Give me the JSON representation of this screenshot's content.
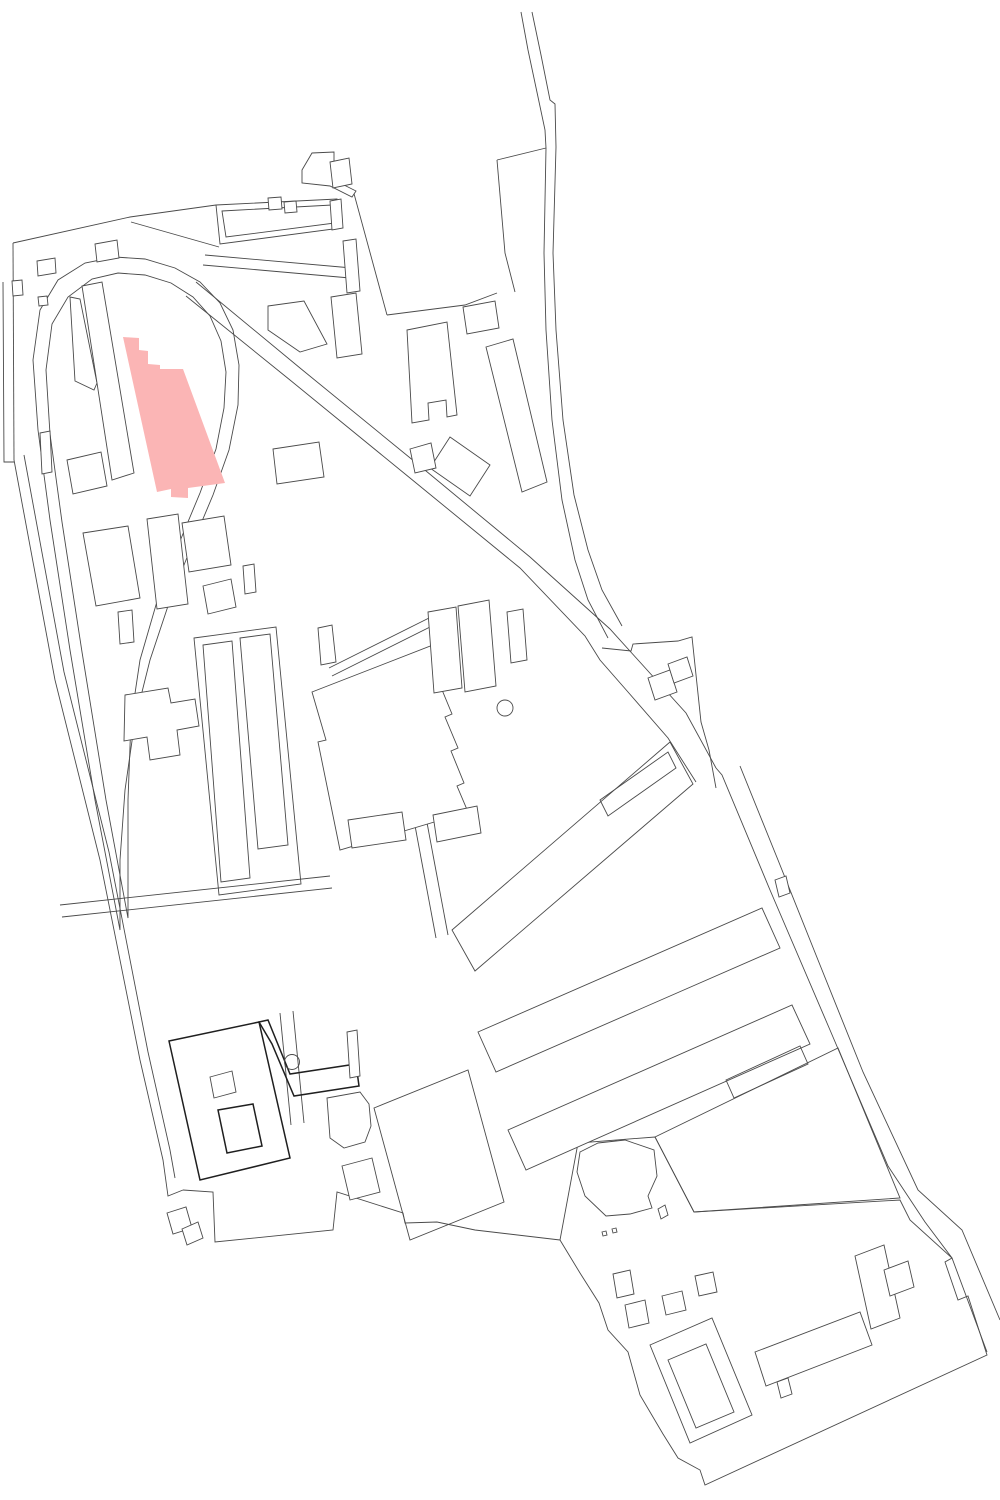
{
  "map": {
    "canvas": {
      "width": 1000,
      "height": 1500,
      "background": "#ffffff"
    },
    "style": {
      "line_color": "#4a4a4a",
      "line_width": 0.9,
      "emphasis_color": "#1f1f1f",
      "emphasis_width": 1.5,
      "building_fill": "#ffffff",
      "highlight_fill": "#fbb5b5"
    },
    "highlight": {
      "name": "highlighted-building",
      "fill": "highlight",
      "points": "123,337 139,338 139,350 148,351 148,364 160,365 160,369 183,369 225,483 188,488 188,498 171,497 171,489 157,492"
    },
    "features": [
      {
        "name": "boundary-top-left",
        "type": "line",
        "points": "13,243 130,217 216,205"
      },
      {
        "name": "boundary-left-vertical",
        "type": "line",
        "points": "13,243 14,460"
      },
      {
        "name": "boundary-left-outer",
        "type": "line",
        "points": "3,282 4,462 14,462"
      },
      {
        "name": "boundary-left-slant-outer",
        "type": "line",
        "points": "14,460 55,680 100,860 140,1060 163,1160 168,1196 183,1190"
      },
      {
        "name": "boundary-left-slant-inner",
        "type": "line",
        "points": "24,455 64,672 109,852 148,1052 170,1150 175,1178"
      },
      {
        "name": "boundary-bottom",
        "type": "line",
        "points": "183,1190 213,1192 215,1242 333,1230 337,1192 403,1213 405,1223 437,1222 475,1230 560,1240"
      },
      {
        "name": "loop-road-outer",
        "type": "polygon",
        "points": "120,930 95,800 70,650 50,520 38,430 33,360 40,310 58,280 85,263 115,257 145,259 175,268 200,282 220,303 233,330 239,365 238,405 229,450 213,495 192,545 170,600 150,660 135,720 125,790 120,860"
      },
      {
        "name": "loop-road-inner",
        "type": "polygon",
        "points": "128,918 106,800 82,652 62,522 50,434 46,370 52,324 68,297 92,279 118,273 145,275 171,283 193,297 210,316 221,341 226,372 224,408 216,449 200,493 180,541 158,598 140,660 131,720 128,800"
      },
      {
        "name": "road-diagonal-upper",
        "type": "line",
        "points": "196,282 300,368 420,466 530,557 610,629 686,713 716,768"
      },
      {
        "name": "road-diagonal-lower",
        "type": "line",
        "points": "186,296 290,380 410,478 520,568 585,636 600,660 628,692 668,738 696,782"
      },
      {
        "name": "road-east-band-left",
        "type": "line",
        "points": "716,768 722,775 770,890 830,1030 888,1166 925,1222 952,1258 987,1352"
      },
      {
        "name": "road-east-band-right",
        "type": "line",
        "points": "740,766 778,860 818,960 863,1072 918,1190 962,1230 1000,1320"
      },
      {
        "name": "road-s-curve-left",
        "type": "line",
        "points": "521,12 528,50 538,97 545,130 546,148 544,253 546,330 552,420 562,500 575,560 588,600 608,638"
      },
      {
        "name": "road-s-curve-right",
        "type": "line",
        "points": "532,12 541,55 550,100 555,104 556,147 553,253 556,330 563,420 574,495 588,550 602,590 622,626"
      },
      {
        "name": "field-north-boundary",
        "type": "line",
        "points": "387,315 465,305 497,293"
      },
      {
        "name": "field-west-boundary",
        "type": "line",
        "points": "353,190 387,315"
      },
      {
        "name": "wedge-left-boundary",
        "type": "line",
        "points": "497,160 505,253 515,292"
      },
      {
        "name": "wedge-top-boundary",
        "type": "line",
        "points": "497,160 546,148"
      },
      {
        "name": "field-east-boundary",
        "type": "line",
        "points": "602,648 631,651 633,644 678,641 692,637 701,722 709,750 716,788"
      },
      {
        "name": "top-band-inner-line",
        "type": "line",
        "points": "131,222 219,247"
      },
      {
        "name": "road-top-cluster-a",
        "type": "line",
        "points": "205,255 352,268"
      },
      {
        "name": "road-top-cluster-b",
        "type": "line",
        "points": "203,265 350,278"
      },
      {
        "name": "road-mid-horizontal-a",
        "type": "line",
        "points": "60,905 330,876"
      },
      {
        "name": "road-mid-horizontal-b",
        "type": "line",
        "points": "62,917 332,888"
      },
      {
        "name": "street-center-a",
        "type": "line",
        "points": "413,815 436,938"
      },
      {
        "name": "street-center-b",
        "type": "line",
        "points": "425,812 448,935"
      },
      {
        "name": "street-left-cluster-a",
        "type": "line",
        "points": "280,1013 291,1125"
      },
      {
        "name": "street-left-cluster-b",
        "type": "line",
        "points": "293,1011 304,1123"
      },
      {
        "name": "path-band-a",
        "type": "line",
        "points": "329,668 441,612"
      },
      {
        "name": "path-band-b",
        "type": "line",
        "points": "332,676 444,620"
      },
      {
        "name": "block-bottomright-outline",
        "type": "polygon",
        "points": "655,1137 838,1048 900,1198 694,1212"
      },
      {
        "name": "compound-outline",
        "type": "polygon",
        "points": "560,1240 578,1143 655,1137 694,1212 900,1200 910,1220 952,1258 945,1262 958,1300 968,1296 987,1355 705,1485 700,1470 678,1458 663,1434 640,1395 628,1352 608,1330 599,1303 580,1273"
      },
      {
        "name": "band-bump-upper",
        "type": "polygon",
        "points": "775,880 786,876 790,893 779,897",
        "fill": "white"
      },
      {
        "name": "band-bump-lower",
        "type": "polygon",
        "points": "777,1382 788,1378 792,1394 781,1398",
        "fill": "white"
      },
      {
        "name": "building-hall-outer",
        "type": "polygon",
        "points": "216,205 337,199 341,228 220,244",
        "fill": "white"
      },
      {
        "name": "building-hall-inner",
        "type": "polygon",
        "points": "222,211 332,205 335,223 226,237"
      },
      {
        "name": "building-hall-annex-a",
        "type": "polygon",
        "points": "268,198 281,197 282,209 269,210",
        "fill": "white"
      },
      {
        "name": "building-hall-annex-b",
        "type": "polygon",
        "points": "284,202 296,201 297,212 285,213",
        "fill": "white"
      },
      {
        "name": "building-tower",
        "type": "polygon",
        "points": "302,170 312,153 334,152 334,180 356,191 352,197 330,186 302,183",
        "fill": "white"
      },
      {
        "name": "building-band-small",
        "type": "polygon",
        "points": "95,244 117,240 119,258 97,262",
        "fill": "white"
      },
      {
        "name": "building-small-a",
        "type": "polygon",
        "points": "37,261 55,258 56,273 38,276",
        "fill": "white"
      },
      {
        "name": "building-small-b",
        "type": "polygon",
        "points": "12,281 22,280 23,295 13,296",
        "fill": "white"
      },
      {
        "name": "building-small-c",
        "type": "polygon",
        "points": "38,297 47,296 48,305 39,306",
        "fill": "white"
      },
      {
        "name": "building-top-east-a",
        "type": "polygon",
        "points": "330,162 349,158 352,184 333,188",
        "fill": "white"
      },
      {
        "name": "building-top-east-b",
        "type": "polygon",
        "points": "330,201 341,199 343,228 332,230",
        "fill": "white"
      },
      {
        "name": "building-narrow-slab",
        "type": "polygon",
        "points": "343,241 356,239 360,291 347,293",
        "fill": "white"
      },
      {
        "name": "building-l-shape",
        "type": "polygon",
        "points": "268,306 304,301 327,344 300,352 268,330",
        "fill": "white"
      },
      {
        "name": "building-slab-330",
        "type": "polygon",
        "points": "331,297 356,293 362,354 337,358",
        "fill": "white"
      },
      {
        "name": "building-u-bottom",
        "type": "polygon",
        "points": "407,330 447,322 457,415 447,417 446,400 428,403 429,420 412,423",
        "fill": "white"
      },
      {
        "name": "building-rect-462",
        "type": "polygon",
        "points": "463,307 495,301 499,328 467,334",
        "fill": "white"
      },
      {
        "name": "building-slab-485",
        "type": "polygon",
        "points": "486,347 513,339 547,482 522,492",
        "fill": "white"
      },
      {
        "name": "building-tilted-square",
        "type": "polygon",
        "points": "450,437 490,465 470,496 430,468",
        "fill": "white"
      },
      {
        "name": "building-tilted-square-annex",
        "type": "polygon",
        "points": "410,449 431,443 436,468 415,473",
        "fill": "white"
      },
      {
        "name": "building-sliver-west",
        "type": "polygon",
        "points": "70,297 80,299 97,383 94,390 75,381",
        "fill": "white"
      },
      {
        "name": "building-slab-west-of-highlight",
        "type": "polygon",
        "points": "82,286 102,282 134,473 112,480",
        "fill": "white"
      },
      {
        "name": "building-rect-40",
        "type": "polygon",
        "points": "40,433 50,431 52,472 42,474",
        "fill": "white"
      },
      {
        "name": "building-rect-67",
        "type": "polygon",
        "points": "67,460 101,452 107,486 73,494",
        "fill": "white"
      },
      {
        "name": "building-rect-273",
        "type": "polygon",
        "points": "273,449 319,442 324,477 277,484",
        "fill": "white"
      },
      {
        "name": "building-slab-83",
        "type": "polygon",
        "points": "83,533 128,526 140,598 96,606",
        "fill": "white"
      },
      {
        "name": "building-rect-118",
        "type": "polygon",
        "points": "118,612 132,610 134,642 120,644",
        "fill": "white"
      },
      {
        "name": "building-slab-147",
        "type": "polygon",
        "points": "147,519 178,514 188,604 157,609",
        "fill": "white"
      },
      {
        "name": "building-rect-182",
        "type": "polygon",
        "points": "182,523 224,516 231,565 189,572",
        "fill": "white"
      },
      {
        "name": "building-square-203",
        "type": "polygon",
        "points": "203,586 231,579 236,607 208,614",
        "fill": "white"
      },
      {
        "name": "building-slab-243",
        "type": "polygon",
        "points": "243,566 254,564 256,592 245,594",
        "fill": "white"
      },
      {
        "name": "building-cross",
        "type": "polygon",
        "points": "125,695 168,688 171,703 195,699 199,726 177,730 180,755 150,760 147,737 124,741",
        "fill": "white"
      },
      {
        "name": "rowhouse-enclosure",
        "type": "polygon",
        "points": "194,638 276,627 301,884 219,895"
      },
      {
        "name": "rowhouse-slab-1",
        "type": "polygon",
        "points": "203,645 232,641 250,878 221,882",
        "fill": "white"
      },
      {
        "name": "rowhouse-slab-2",
        "type": "polygon",
        "points": "240,638 270,634 288,845 258,849",
        "fill": "white"
      },
      {
        "name": "building-big-square",
        "type": "polygon",
        "points": "312,692 433,645 447,682 440,685 452,714 445,717 458,748 451,751 464,783 457,786 468,812 340,850 318,742 326,740",
        "fill": "white"
      },
      {
        "name": "building-tab-above-square",
        "type": "polygon",
        "points": "318,628 332,625 336,662 321,665",
        "fill": "white"
      },
      {
        "name": "building-cluster-458",
        "type": "polygon",
        "points": "458,606 489,600 496,686 465,692",
        "fill": "white"
      },
      {
        "name": "building-cluster-428",
        "type": "polygon",
        "points": "428,612 456,607 462,688 434,693",
        "fill": "white"
      },
      {
        "name": "building-cluster-arm",
        "type": "polygon",
        "points": "507,612 523,609 527,660 511,663",
        "fill": "white"
      },
      {
        "name": "landmark-circle-north",
        "type": "circle",
        "cx": 505,
        "cy": 708,
        "r": 8
      },
      {
        "name": "building-rect-348",
        "type": "polygon",
        "points": "348,820 402,812 406,840 352,848",
        "fill": "white"
      },
      {
        "name": "building-rect-433",
        "type": "polygon",
        "points": "433,815 477,806 481,833 437,842",
        "fill": "white"
      },
      {
        "name": "building-tilt-east-a",
        "type": "polygon",
        "points": "648,678 670,670 677,692 655,700",
        "fill": "white"
      },
      {
        "name": "building-tilt-east-b",
        "type": "polygon",
        "points": "668,664 687,657 693,676 674,683",
        "fill": "white"
      },
      {
        "name": "slab-row-a",
        "type": "polygon",
        "points": "452,930 670,742 693,784 475,971",
        "fill": "white"
      },
      {
        "name": "slab-row-a-inner",
        "type": "polygon",
        "points": "600,800 668,752 676,768 608,816"
      },
      {
        "name": "slab-row-b",
        "type": "polygon",
        "points": "478,1032 762,908 780,948 496,1072",
        "fill": "white"
      },
      {
        "name": "slab-row-c",
        "type": "polygon",
        "points": "508,1130 792,1005 810,1044 526,1170",
        "fill": "white"
      },
      {
        "name": "slab-row-c-inner",
        "type": "polygon",
        "points": "726,1080 800,1046 808,1064 734,1098"
      },
      {
        "name": "courtyard-ring-outer",
        "type": "polygon",
        "points": "169,1041 259,1022 290,1158 200,1180",
        "fill": "white",
        "emphasis": true
      },
      {
        "name": "courtyard-ring-court",
        "type": "polygon",
        "points": "218,1110 253,1104 262,1146 227,1153",
        "fill": "white",
        "emphasis": true
      },
      {
        "name": "courtyard-inner-rect",
        "type": "polygon",
        "points": "210,1077 232,1071 236,1092 214,1098"
      },
      {
        "name": "courtyard-arm-east",
        "type": "polygon",
        "points": "259,1022 268,1020 290,1074 356,1064 359,1086 294,1096 272,1044",
        "emphasis": true
      },
      {
        "name": "courtyard-bar",
        "type": "polygon",
        "points": "347,1032 357,1030 360,1076 350,1078",
        "fill": "white"
      },
      {
        "name": "landmark-circle-south",
        "type": "circle",
        "cx": 292,
        "cy": 1062,
        "r": 7.5
      },
      {
        "name": "building-d-shape",
        "type": "polygon",
        "points": "327,1098 360,1092 369,1104 371,1126 365,1142 344,1148 330,1138",
        "fill": "white"
      },
      {
        "name": "building-tilt-square-south",
        "type": "polygon",
        "points": "342,1166 372,1158 380,1192 350,1200",
        "fill": "white"
      },
      {
        "name": "block-big-rect-south",
        "type": "polygon",
        "points": "374,1108 468,1070 504,1202 410,1240"
      },
      {
        "name": "tip-fragment-a",
        "type": "polygon",
        "points": "167,1213 186,1207 192,1228 173,1234",
        "fill": "white"
      },
      {
        "name": "tip-fragment-b",
        "type": "polygon",
        "points": "182,1229 198,1222 203,1238 187,1245",
        "fill": "white"
      },
      {
        "name": "building-irregular-flag",
        "type": "polygon",
        "points": "580,1152 598,1143 625,1140 654,1150 657,1176 648,1196 652,1208 630,1214 606,1216 585,1196 577,1172",
        "fill": "white"
      },
      {
        "name": "fragment-sliver",
        "type": "polygon",
        "points": "658,1209 665,1205 668,1215 661,1219",
        "fill": "white"
      },
      {
        "name": "fragment-dot-a",
        "type": "polygon",
        "points": "602,1232 606,1231 607,1235 603,1236"
      },
      {
        "name": "fragment-dot-b",
        "type": "polygon",
        "points": "612,1229 616,1228 617,1232 613,1233"
      },
      {
        "name": "compound-square-1",
        "type": "polygon",
        "points": "613,1274 630,1270 634,1294 617,1298",
        "fill": "white"
      },
      {
        "name": "compound-square-2",
        "type": "polygon",
        "points": "625,1305 645,1300 649,1323 629,1328",
        "fill": "white"
      },
      {
        "name": "compound-square-3",
        "type": "polygon",
        "points": "662,1296 682,1291 686,1310 666,1315",
        "fill": "white"
      },
      {
        "name": "compound-square-4",
        "type": "polygon",
        "points": "695,1276 713,1272 717,1292 699,1296",
        "fill": "white"
      },
      {
        "name": "compound-ring-outer",
        "type": "polygon",
        "points": "650,1345 712,1318 752,1415 690,1443",
        "fill": "white"
      },
      {
        "name": "compound-ring-inner",
        "type": "polygon",
        "points": "668,1360 706,1344 734,1412 696,1428"
      },
      {
        "name": "compound-central-slab",
        "type": "polygon",
        "points": "755,1352 860,1312 872,1345 766,1386",
        "fill": "white"
      },
      {
        "name": "compound-t-building",
        "type": "polygon",
        "points": "855,1256 884,1245 900,1318 871,1329",
        "fill": "white"
      },
      {
        "name": "compound-t-arm",
        "type": "polygon",
        "points": "884,1270 908,1261 914,1287 890,1296",
        "fill": "white"
      }
    ]
  }
}
